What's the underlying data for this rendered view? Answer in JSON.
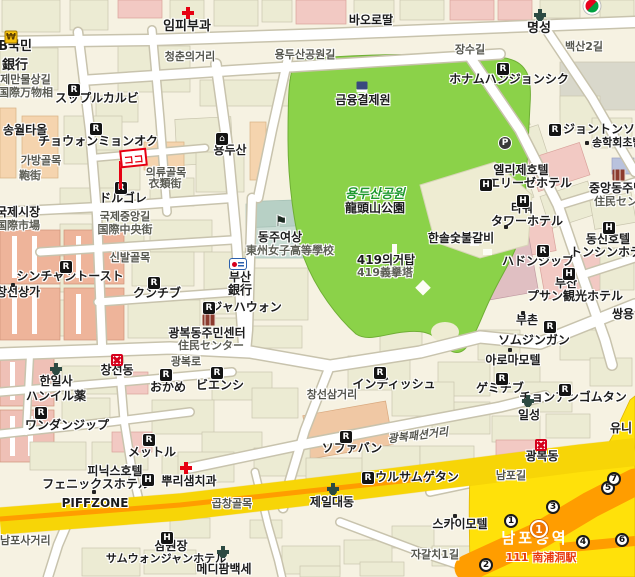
{
  "title": "부산 남포동 · 용두산공원 주변 지도",
  "colors": {
    "background": "#f6f2e2",
    "park_green": "#8bd249",
    "road_white": "#ffffff",
    "major_road_yellow": "#ffe10a",
    "station_band_orange": "#ff9d00",
    "marker_red": "#e60012",
    "building_tan": "#ecebd3",
    "building_pink": "#f2c9c3",
    "building_salmon": "#eeb49a",
    "school_teal": "#cadcd4"
  },
  "icons": {
    "restaurant": "R",
    "hotel": "H",
    "parking": "P",
    "won": "₩",
    "house": "⌂",
    "school_flag": "⚑"
  },
  "marker": {
    "label": "ココ"
  },
  "station": {
    "name": "남포동역",
    "line_station": "111 南浦洞駅",
    "badge_number": "1",
    "exit_numbers": [
      "1",
      "2",
      "3",
      "4",
      "5",
      "6",
      "7"
    ]
  },
  "labels": {
    "impi_clinic": "임피부과",
    "myeongseong": "명성",
    "baorottal": "바오로딸",
    "kb_bank_ko": "KB국민",
    "kb_bank_kanji": "銀行",
    "gukje_manmul_gil": "국제만물상길",
    "gukje_manmul_kanji": "国際万物相",
    "seuppeul_kalbi": "スップルカルビ",
    "yongdusan_gongwon_gil": "용두산공원길",
    "geumyung": "금융결제원",
    "jangsu_gil": "장수길",
    "baeksan_2gil": "백산2길",
    "honam_hanjeongsik": "ホナムハンジョンシク",
    "cheongchun_st": "청춘의거리",
    "jeonton_songa": "ジョントンソンガ",
    "songhak": "송학회초밥",
    "ellije_hotel_ko": "엘리제호텔",
    "ellije_hotel_ja": "エリーゼホテル",
    "jungang_jumin_ko": "중앙동주민센터",
    "jungang_jumin_ja": "住民センター",
    "tower_ko": "타워",
    "tower_ja": "タワーホテル",
    "hansol": "한솔숯불갈비",
    "hadongjip": "ハドンジップ",
    "dongsin_ko": "동신호텔",
    "dongsin_ja": "トンシンホテル",
    "busan_hotel_ko": "부산",
    "busan_hotel_ja": "プサン観光ホテル",
    "buchon": "부촌",
    "ssangyong": "쌍용",
    "somjingang": "ソムジンガン",
    "aroma_motel": "아로마모텔",
    "gemichib": "ゲミチブ",
    "cheonan_gomtang": "チョンアンゴムタン",
    "ilseong": "일성",
    "uni": "유니",
    "gwangbok_dong": "광복동",
    "nampo_gil": "남포길",
    "sky_motel": "스카이모텔",
    "jagalchi_1gil": "자갈치1길",
    "jeil_daedong": "제일대동",
    "gopchang_golmok": "곱창골목",
    "medipharm": "메디팜백세",
    "samwonjang_ko": "삼원장",
    "samwonjang_ja": "サムウォンジャンホテル",
    "nampo_sageori": "남포사거리",
    "piffzone": "PIFFZONE",
    "phoenix_ko": "피닉스호텔",
    "phoenix_ja": "フェニックスホテル",
    "ppuri_dental": "뿌리샘치과",
    "mettle": "メットル",
    "sofabang": "ソファバン",
    "gwangbok_fashion_st": "광복패션거리",
    "seoul_samgyetang": "ソウルサムゲタン",
    "indish": "インディッシュ",
    "changseon_samgeori": "창선삼거리",
    "biensi": "ビエンシ",
    "gwangbok_jumin_ko": "광복동주민센터",
    "gwangbok_jumin_ja": "住民センター",
    "gwangbok_ro": "광복로",
    "okame": "おかめ",
    "changseon_dong": "창선동",
    "hanilsa_ko": "한일사",
    "hanilsa_ja": "ハンイル薬",
    "wandanjip": "ワンダンジップ",
    "gukje_sijang_ko": "국제시장",
    "gukje_sijang_kanji": "国際市場",
    "changseon_sangga": "창선상가",
    "shinchan_toast": "シンチャントースト",
    "sinbal_golmok": "신발골목",
    "kunchib": "クンチブ",
    "gukje_jungang_gil": "국제중앙길",
    "gukje_jungang_kanji": "国際中央街",
    "dolgore": "ドルゴレ",
    "uiryu_golmok": "의류골목",
    "uiryu_kanji": "衣類街",
    "gabang_golmok": "가방골목",
    "gabang_kanji": "鞄街",
    "songwol": "송월타올",
    "chowon_myeonok": "チョウォンミョンオク",
    "yongdusan_poi": "용두산",
    "dongju_ko": "동주여상",
    "dongju_kanji": "東州女子高等學校",
    "busan_bank_ko": "부산",
    "busan_bank_kanji": "銀行",
    "jahawon": "ジャハウォン",
    "t419_ko": "419의거탑",
    "t419_kanji": "419義擧塔",
    "park_ko": "용두산공원",
    "park_kanji": "龍頭山公園"
  }
}
